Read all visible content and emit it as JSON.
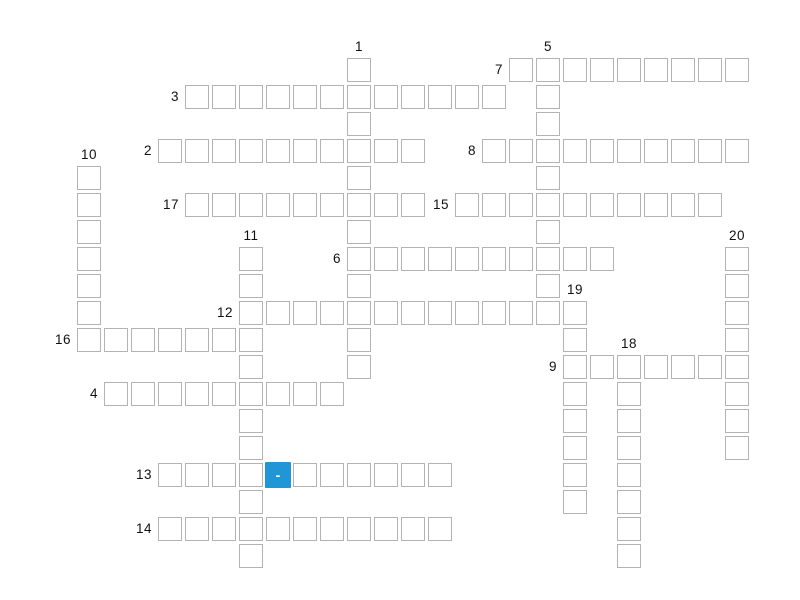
{
  "puzzle": {
    "background_color": "#ffffff",
    "cell": {
      "size": 24,
      "pitch": 27,
      "origin_x": 77,
      "origin_y": 58,
      "border_color": "#b3b3b3",
      "fill_color": "#ffffff"
    },
    "label": {
      "color": "#111111",
      "font_size": 13.5
    },
    "highlight": {
      "col": 7,
      "row": 15,
      "color": "#2196d6",
      "text": "-",
      "text_color": "#ffffff"
    },
    "entries": [
      {
        "number": 1,
        "direction": "down",
        "row": 0,
        "col": 10,
        "length": 12
      },
      {
        "number": 2,
        "direction": "across",
        "row": 3,
        "col": 3,
        "length": 10
      },
      {
        "number": 3,
        "direction": "across",
        "row": 1,
        "col": 4,
        "length": 12
      },
      {
        "number": 4,
        "direction": "across",
        "row": 12,
        "col": 1,
        "length": 9
      },
      {
        "number": 5,
        "direction": "down",
        "row": 0,
        "col": 17,
        "length": 10
      },
      {
        "number": 6,
        "direction": "across",
        "row": 7,
        "col": 10,
        "length": 10
      },
      {
        "number": 7,
        "direction": "across",
        "row": 0,
        "col": 16,
        "length": 9
      },
      {
        "number": 8,
        "direction": "across",
        "row": 3,
        "col": 15,
        "length": 10
      },
      {
        "number": 9,
        "direction": "across",
        "row": 11,
        "col": 18,
        "length": 7
      },
      {
        "number": 10,
        "direction": "down",
        "row": 4,
        "col": 0,
        "length": 7
      },
      {
        "number": 11,
        "direction": "down",
        "row": 7,
        "col": 6,
        "length": 12
      },
      {
        "number": 12,
        "direction": "across",
        "row": 9,
        "col": 6,
        "length": 13
      },
      {
        "number": 13,
        "direction": "across",
        "row": 15,
        "col": 3,
        "length": 11
      },
      {
        "number": 14,
        "direction": "across",
        "row": 17,
        "col": 3,
        "length": 11
      },
      {
        "number": 15,
        "direction": "across",
        "row": 5,
        "col": 14,
        "length": 10
      },
      {
        "number": 16,
        "direction": "across",
        "row": 10,
        "col": 0,
        "length": 7
      },
      {
        "number": 17,
        "direction": "across",
        "row": 5,
        "col": 4,
        "length": 9
      },
      {
        "number": 18,
        "direction": "down",
        "row": 11,
        "col": 20,
        "length": 8
      },
      {
        "number": 19,
        "direction": "down",
        "row": 9,
        "col": 18,
        "length": 8
      },
      {
        "number": 20,
        "direction": "down",
        "row": 7,
        "col": 24,
        "length": 8
      }
    ]
  }
}
